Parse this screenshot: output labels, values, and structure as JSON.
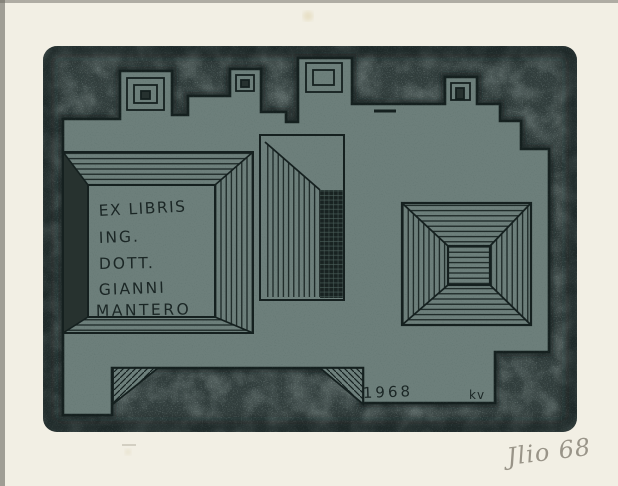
{
  "artwork": {
    "kind": "ex-libris etching print on cream paper",
    "bookplate": {
      "lines": [
        "EX LIBRIS",
        "ING.",
        "DOTT.",
        "GIANNI",
        "MANTERO"
      ],
      "year": "1968",
      "artist_monogram": "kv"
    },
    "pencil_inscription": "Jlio 68",
    "palette": {
      "paper": "#f2efe4",
      "plate": "#313d3c",
      "relief": "#6d7f7b",
      "ink": "#15201f",
      "pencil": "#8a8579"
    }
  }
}
